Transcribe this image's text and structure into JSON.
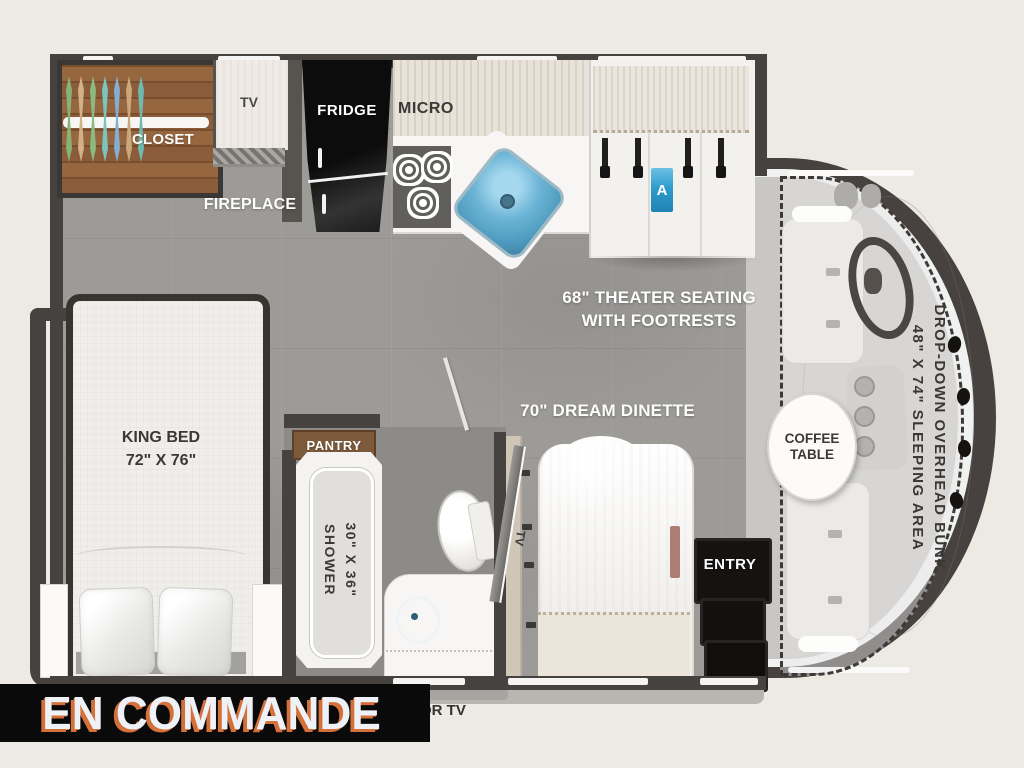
{
  "plan": {
    "status_banner": "EN COMMANDE",
    "labels": {
      "closet": "CLOSET",
      "tv": "TV",
      "fireplace": "FIREPLACE",
      "fridge": "FRIDGE",
      "micro": "MICRO",
      "cabinet_tag": "A",
      "theater_line1": "68\" THEATER SEATING",
      "theater_line2": "WITH FOOTRESTS",
      "dinette": "70\" DREAM DINETTE",
      "king_bed_line1": "KING BED",
      "king_bed_line2": "72\" X 76\"",
      "pantry": "PANTRY",
      "shower_size": "30\" X 36\"",
      "shower": "SHOWER",
      "dinette_tv": "TV",
      "entry": "ENTRY",
      "coffee_line1": "COFFEE",
      "coffee_line2": "TABLE",
      "bunk_line1": "DROP-DOWN OVERHEAD BUNK",
      "bunk_line2": "48\" X 74\" SLEEPING AREA",
      "or_tv": "OR TV"
    },
    "colors": {
      "wall": "#46423f",
      "floor": "#9d9b98",
      "wood": "#8a5c39",
      "accent_blue": "#2f9ccc",
      "sink_blue": "#6cb4d6",
      "banner_bg": "#0b0a0a",
      "banner_text": "#eef1f5",
      "banner_shadow": "#d4703a"
    },
    "decor": {
      "closet_items": [
        "#86b478",
        "#d2b189",
        "#8cb980",
        "#7cc4bd",
        "#86aed0",
        "#caa87c",
        "#6fb9b0"
      ]
    }
  }
}
